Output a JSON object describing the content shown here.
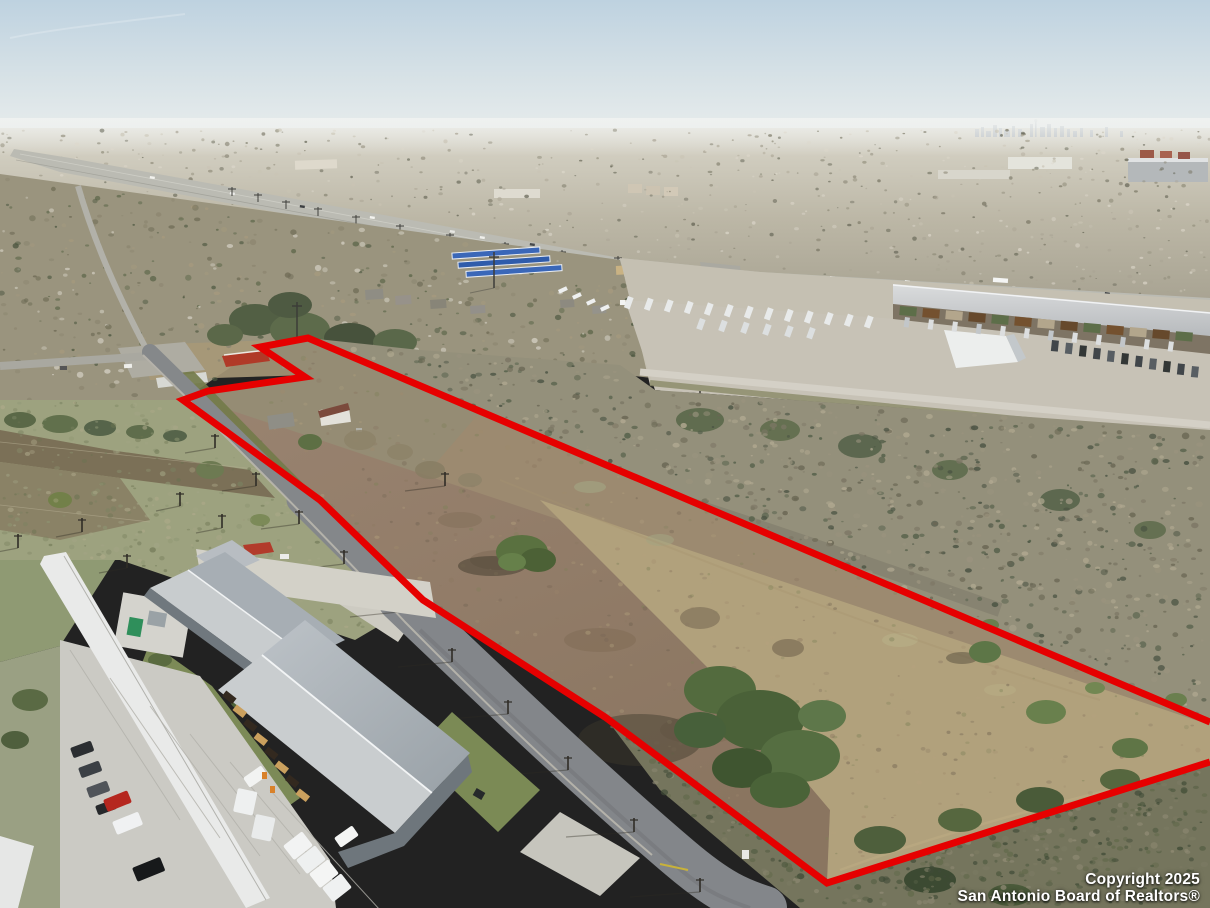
{
  "scene": {
    "description": "Aerial drone photo of a vacant land parcel outlined in red beside a two-lane road, with a highway, truck stop, industrial warehouse park, distant San Antonio skyline and a metal commercial building in the foreground",
    "boundary_color": "#e60000"
  },
  "watermark": {
    "line1": "Copyright 2025",
    "line2": "San Antonio Board of Realtors®"
  },
  "boundary": {
    "color": "#e60000",
    "stroke_width": 7,
    "path": "M 1210,722 L 308,338 L 260,347 L 305,377 L 208,391 L 183,400 L 320,500 L 423,600 L 605,717 L 827,883 L 1210,762"
  }
}
